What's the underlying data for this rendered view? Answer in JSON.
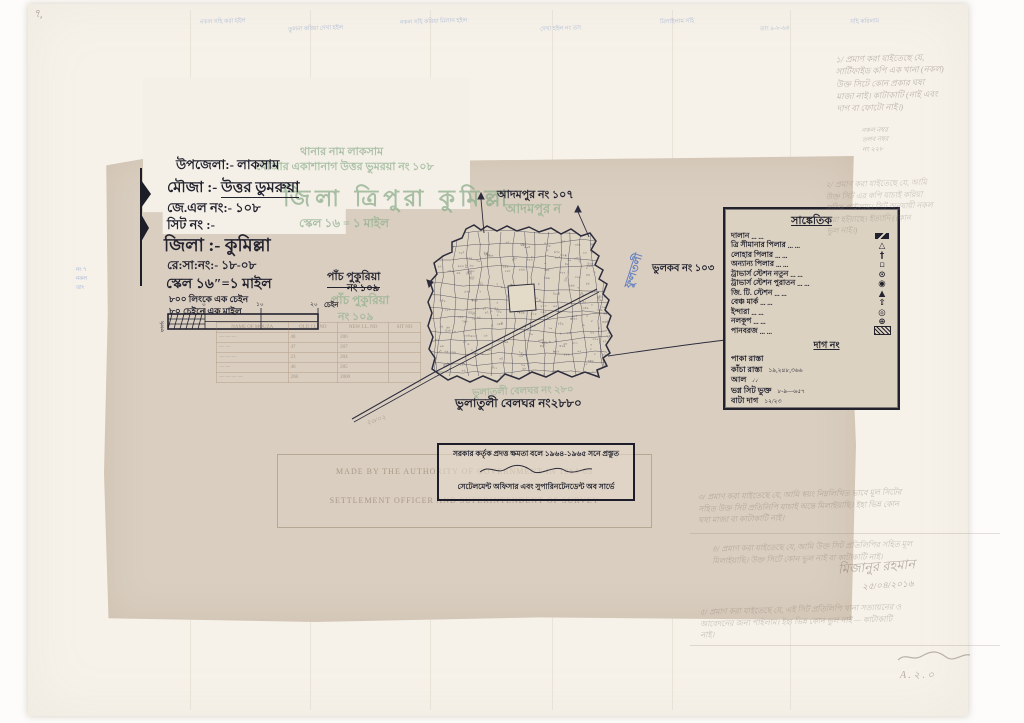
{
  "header": {
    "upazila": "উপজেলা:- লাকসাম",
    "mouza_label": "মৌজা :-",
    "mouza_value": "উত্তর ডুমরুয়া",
    "jl_no": "জে.এল নং:- ১০৮",
    "sheet_no": "সিট নং :-",
    "district": "জিলা :- কুমিল্লা",
    "resa_no": "রে:সা:নং:-  ১৮-০৮",
    "scale": "স্কেল ১৬″=১ মাইল",
    "scale_note1": "৮০০ লিংকে এক চেইন",
    "scale_note2": "৮০ চেইনে এক মাইল"
  },
  "faded_underprint": {
    "thana": "থানার নাম  লাকসাম",
    "mouza": "মৌজার একাশানাগ উত্তর ভুমরয়া নং ১০৮",
    "district_big": "জিলা ত্রিপুরা কুমিল্লা",
    "scale": "স্কেল ১৬ = ১ মাইল",
    "adampur": "আদমপুর ন",
    "panchpukuria1": "পাঁচ পুকুরিয়া",
    "panchpukuria2": "নং ১০৯",
    "belghar": "ভুলাতলী বেলঘর নং ২৮০"
  },
  "map_labels": {
    "north": "আদমপুর নং ১০৭",
    "east": "ভুলকব নং ১০৩",
    "west1": "পাঁচ পুকুরিয়া",
    "west2": "নং ১০৯",
    "south": "ভুলাতুলী বেলঘর নং২৮৮০",
    "blue_vertical": "ফুলতলী"
  },
  "scale_bar": {
    "ticks": [
      "০",
      "১০",
      "২০"
    ],
    "unit": "চেইন",
    "side": "ফার্লং"
  },
  "legend": {
    "title": "সাঙ্কেতিক",
    "items": [
      {
        "label": "দালান",
        "symbol": "building-swatch"
      },
      {
        "label": "ত্রি সীমানার পিলার",
        "symbol": "△"
      },
      {
        "label": "লোহার পিলার",
        "symbol": "†"
      },
      {
        "label": "অন্যান্য পিলার",
        "symbol": "▫"
      },
      {
        "label": "ট্রাভার্স স্টেশন নতুন",
        "symbol": "⊙"
      },
      {
        "label": "ট্রাভার্স স্টেশন পুরাতন",
        "symbol": "◉"
      },
      {
        "label": "জি. টি. স্টেশন",
        "symbol": "▲"
      },
      {
        "label": "বেঞ্চ মার্ক",
        "symbol": "⇧"
      },
      {
        "label": "ইন্দারা",
        "symbol": "◎"
      },
      {
        "label": "নলকূপ",
        "symbol": "⊕"
      },
      {
        "label": "পানবরজ",
        "symbol": "hatch-swatch"
      }
    ],
    "sub_title": "দাগ নং",
    "road_items": [
      {
        "label": "পাকা রাস্তা",
        "symbol": ""
      },
      {
        "label": "কাঁচা রাস্তা",
        "symbol": "১৯,২৪৮,৩৬৬"
      },
      {
        "label": "আল",
        "symbol": "৴৴"
      },
      {
        "label": "ভগ্ন সিট ভুক্ত",
        "symbol": "৮-৯—৬৫৭"
      },
      {
        "label": "বাটা দাগ",
        "symbol": "১২/২৩"
      }
    ]
  },
  "stamp": {
    "line1": "সরকার কর্তৃক প্রদত্ত ক্ষমতা বলে ১৯৬৪-১৯৬৫ সনে প্রস্তুত",
    "line3": "সেটেলমেন্ট অফিসার এবং সুপারিনটেনডেন্ট অব সার্ভে"
  },
  "faded_stamp": {
    "line1": "MADE BY THE AUTHORITY OF GOVERNMENT IN 1964-65",
    "line2": "SETTLEMENT OFFICER AND SUPERINTENDENT OF SURVEY"
  },
  "faded_table": {
    "headers": [
      "NAME OF MOUZA",
      "OLD J.L. NO",
      "NEW J.L. NO",
      "SIT NO"
    ],
    "rows": [
      [
        "— — —",
        "48",
        "206",
        ""
      ],
      [
        "— —",
        "47",
        "207",
        ""
      ],
      [
        "— — —",
        "23",
        "204",
        ""
      ],
      [
        "— —",
        "46",
        "205",
        ""
      ],
      [
        "— — — —",
        "268",
        "2000",
        ""
      ]
    ]
  },
  "notes": {
    "corner_mark": "৭,",
    "top_strip": [
      "নকল সহি করা হইল",
      "তুলনা করিয়া দেখা হইল",
      "নকল সহি করিয়া মিলান হইল",
      "দেখা হইল নং তাং",
      "মিলাইলাম সহি",
      "তাং ৯-৮-৬৪",
      "সহি করিলাম"
    ],
    "left_margin": [
      "নং ৭",
      "নকল",
      "তাং"
    ],
    "right_top": [
      "১/ প্রমাণ করা যাইতেছে যে,",
      "সার্টিফাইড কপি এক খানা (নকল)",
      "উক্ত সিটে কোন প্রকার ঘষা",
      "মাজা নাই। কাটাকাটি (নাই এবং",
      "দাগ বা ফোটো নাই।)"
    ],
    "right_mid_small": [
      "নকল নম্বর",
      "তলব নম্বর",
      "নং ২২৮"
    ],
    "right_block2": [
      "২/ প্রমাণ করা যাইতেছে যে, আমি",
      "উক্ত সিট এর কপি যাচাই করিয়া",
      "সঠিক পাইলাম। সিট অনুযায়ী নকল",
      "করা হইয়াছে। ইত্যাদি (কোন",
      "ভুল নাই।)"
    ],
    "bottom_note1": [
      "৩/ প্রমাণ করা যাইতেছে যে, আমি স্বয়ং নিম্নলিখিত ভাবে মূল সিটের",
      "সহিত উক্ত সিট প্রতিলিপি যাচাই অন্তে মিলাইয়াছি। ইহা ভিন্ন কোন",
      "ঘষা মাজা বা কাটাকাটি নাই।"
    ],
    "bottom_note2": [
      "৪/ প্রমাণ করা যাইতেছে যে, আমি উক্ত সিট প্রতিলিপির সহিত মূল",
      "মিলাইয়াছি। উক্ত সিটে কোন ভুল নাই বা কাটাকাটি নাই।"
    ],
    "signature": "মিজানুর রহমান",
    "date": "২৫/০৪/২০১৬",
    "bottom_note3": [
      "৫/ প্রমাণ করা যাইতেছে যে, এই সিট প্রতিলিপি খানা সত্যায়নের ও",
      "আবেদনের জন্য পাইলাম। ইহা ভিন্ন কোন ভুল নাই — কাটাকাটি",
      "নাই।"
    ],
    "initial": "A . ২ . ০",
    "near_road": "২৬/০২"
  },
  "colors": {
    "ink": "#23232f",
    "faded_green": "#8fae8c",
    "blue_ink": "#4a6fc0",
    "pencil": "#8a7e72",
    "tan_paper": "#d9cec0",
    "sheet": "#f6f2ea"
  }
}
